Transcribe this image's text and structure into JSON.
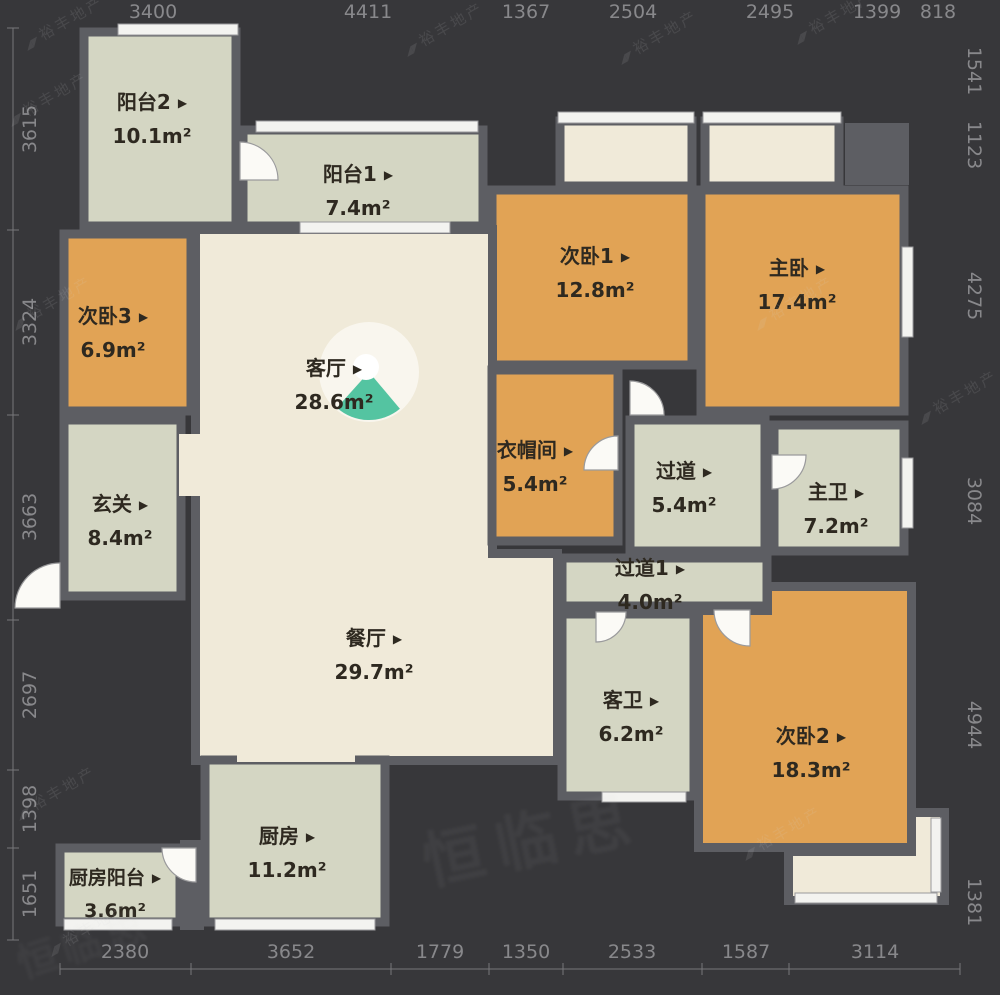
{
  "colors": {
    "bg": "#37373a",
    "wall": "#5d5e63",
    "sage": "#d4d6c3",
    "orange": "#e1a355",
    "cream": "#f0ead9",
    "teal": "#45bf9a",
    "win": "#f3f3f0",
    "dim": "#97979a",
    "label": "#2e2920"
  },
  "ui": {
    "marker": "▶"
  },
  "watermark": {
    "brand": "裕丰地产",
    "big": "恒临思"
  },
  "rooms": {
    "balcony2": {
      "name": "阳台2",
      "area": "10.1m²"
    },
    "balcony1": {
      "name": "阳台1",
      "area": "7.4m²"
    },
    "bedroom1": {
      "name": "次卧1",
      "area": "12.8m²"
    },
    "master": {
      "name": "主卧",
      "area": "17.4m²"
    },
    "bedroom3": {
      "name": "次卧3",
      "area": "6.9m²"
    },
    "living": {
      "name": "客厅",
      "area": "28.6m²"
    },
    "closet": {
      "name": "衣帽间",
      "area": "5.4m²"
    },
    "corridor": {
      "name": "过道",
      "area": "5.4m²"
    },
    "masterbath": {
      "name": "主卫",
      "area": "7.2m²"
    },
    "hall": {
      "name": "玄关",
      "area": "8.4m²"
    },
    "dining": {
      "name": "餐厅",
      "area": "29.7m²"
    },
    "corridor1": {
      "name": "过道1",
      "area": "4.0m²"
    },
    "guestbath": {
      "name": "客卫",
      "area": "6.2m²"
    },
    "bedroom2": {
      "name": "次卧2",
      "area": "18.3m²"
    },
    "kitchen": {
      "name": "厨房",
      "area": "11.2m²"
    },
    "kitchenbalcony": {
      "name": "厨房阳台",
      "area": "3.6m²"
    }
  },
  "dims": {
    "top": [
      "3400",
      "4411",
      "1367",
      "2504",
      "2495",
      "1399",
      "818"
    ],
    "bottom": [
      "2380",
      "3652",
      "1779",
      "1350",
      "2533",
      "1587",
      "3114"
    ],
    "left": [
      "3615",
      "3324",
      "3663",
      "2697",
      "1398",
      "1651"
    ],
    "right": [
      "1541",
      "1123",
      "4275",
      "3084",
      "4944",
      "1381"
    ]
  }
}
